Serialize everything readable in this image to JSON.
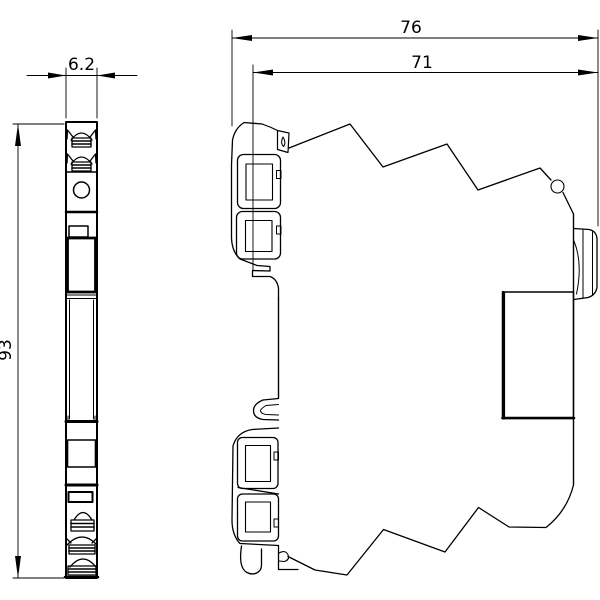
{
  "drawing": {
    "background_color": "#ffffff",
    "line_color": "#000000",
    "dimensions": {
      "width": "6.2",
      "height": "93",
      "depth_total": "76",
      "depth_body": "71"
    }
  }
}
